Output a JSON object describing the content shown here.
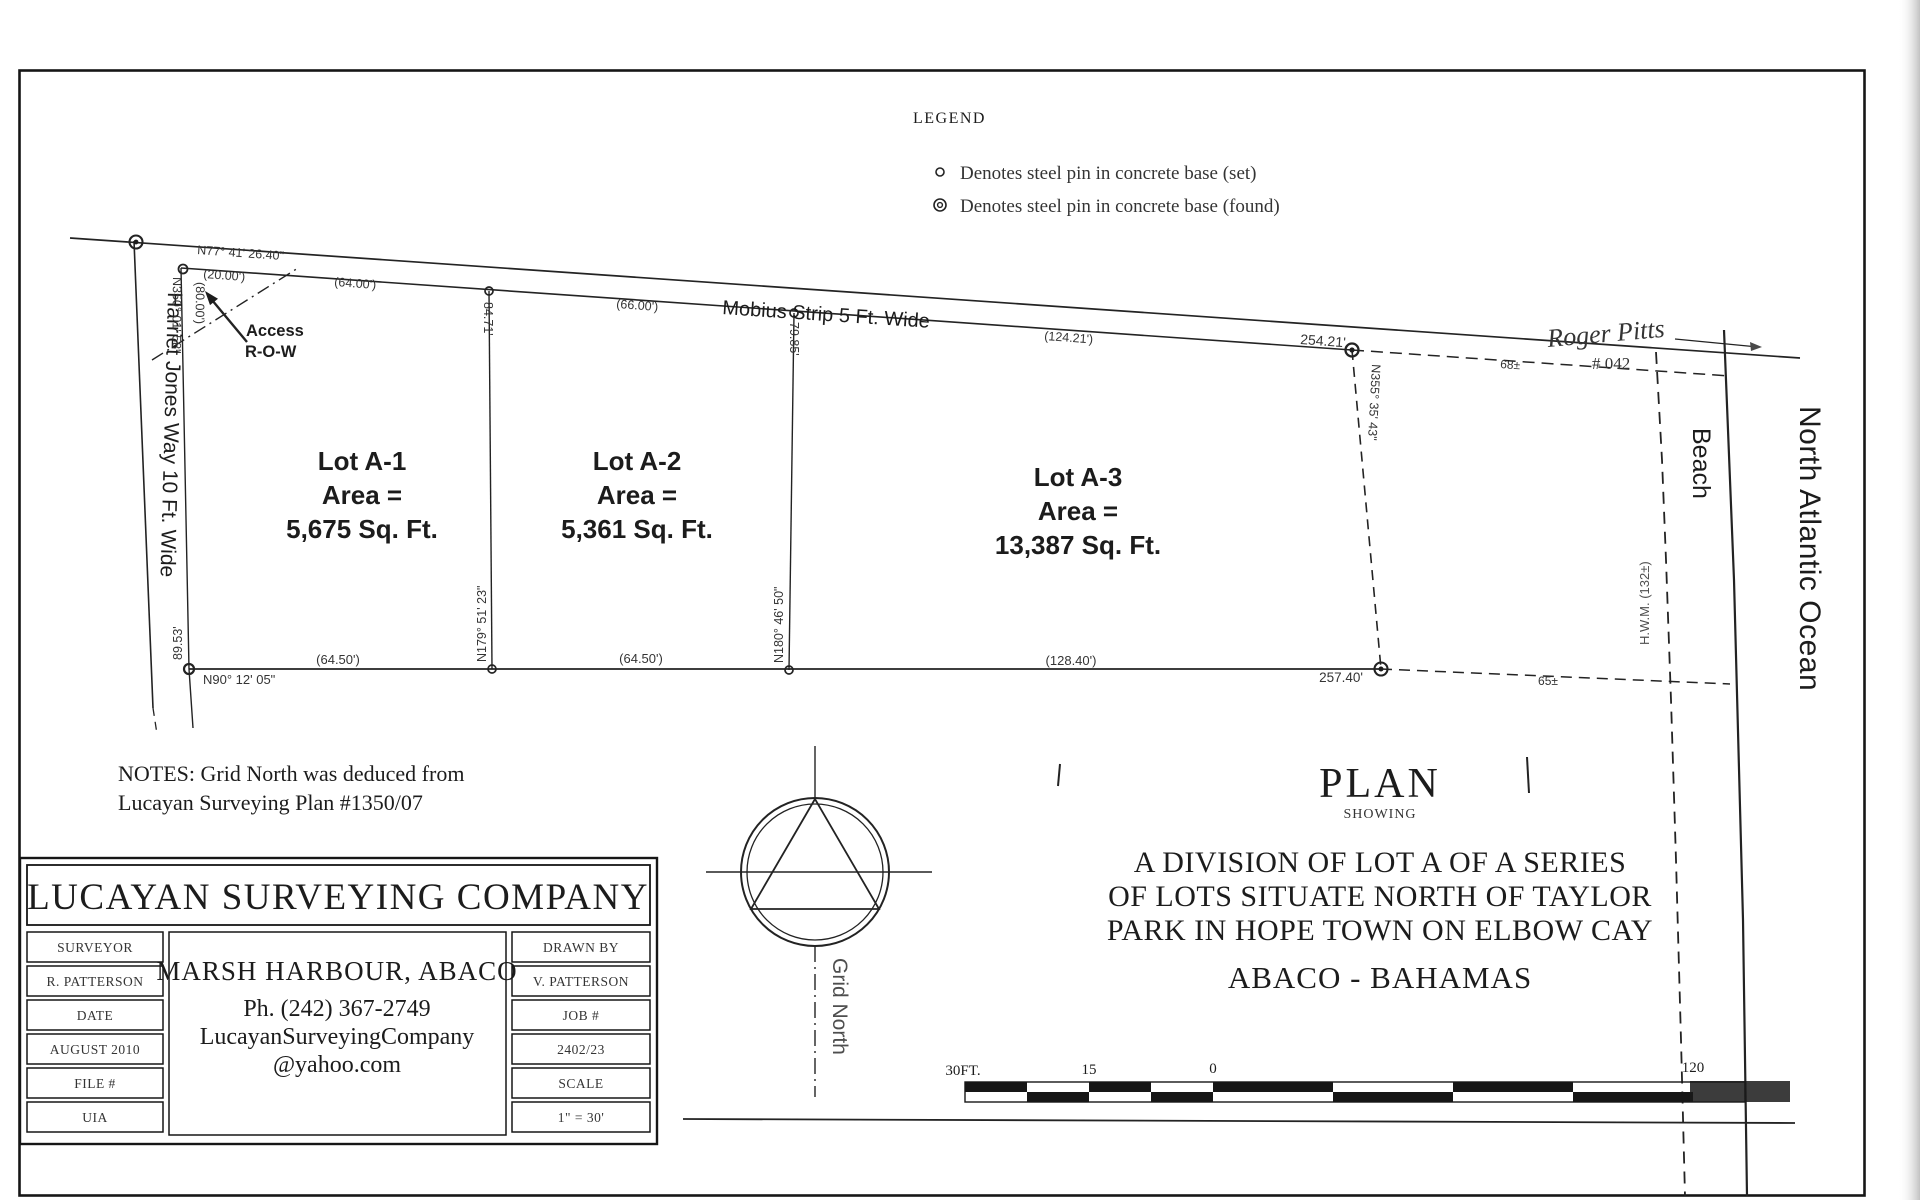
{
  "legend": {
    "title": "LEGEND",
    "items": [
      {
        "icon": "set-pin",
        "text": "Denotes steel pin in concrete base (set)"
      },
      {
        "icon": "found-pin",
        "text": "Denotes steel pin in concrete base (found)"
      }
    ]
  },
  "drawing": {
    "streets": {
      "harriet": "Harriet Jones Way  10 Ft. Wide",
      "mobius": "Mobius Strip  5 Ft. Wide"
    },
    "access": {
      "line1": "Access",
      "line2": "R-O-W"
    },
    "lots": [
      {
        "name": "Lot A-1",
        "area_eq": "Area =",
        "area": "5,675 Sq. Ft."
      },
      {
        "name": "Lot A-2",
        "area_eq": "Area =",
        "area": "5,361 Sq. Ft."
      },
      {
        "name": "Lot A-3",
        "area_eq": "Area =",
        "area": "13,387 Sq. Ft."
      }
    ],
    "dims": {
      "nw_bearing": "N77° 41' 26.40\"",
      "nw_dist": "(20.00')",
      "west_bearing": "N350° 01' 58\"",
      "west_dist": "(80.00')",
      "west_meas": "89.53'",
      "south_bearing": "N90° 12' 05\"",
      "a1_top": "(64.00')",
      "a1_bottom": "(64.50')",
      "a12_meas": "84.71'",
      "a12_bearing": "N179° 51' 23\"",
      "a2_top": "(66.00')",
      "a2_bottom": "(64.50')",
      "a23_meas": "79.85'",
      "a23_bearing": "N180° 46' 50\"",
      "a3_top": "(124.21')",
      "a3_bottom": "(128.40')",
      "east_top": "254.21'",
      "east_bottom": "257.40'",
      "east_bearing": "N355° 35' 43\"",
      "beach_top": "68±",
      "beach_bottom": "65±",
      "hwm_label": "H.W.M. (132±)"
    },
    "labels": {
      "beach": "Beach",
      "ocean": "North Atlantic Ocean",
      "grid_north": "Grid North"
    },
    "signature": {
      "name": "Roger Pitts",
      "number": "# 042"
    }
  },
  "notes": {
    "line1": "NOTES: Grid North was deduced from",
    "line2": "Lucayan Surveying Plan #1350/07"
  },
  "title_block": {
    "plan": "PLAN",
    "showing": "SHOWING",
    "line1": "A DIVISION OF LOT A OF A SERIES",
    "line2": "OF LOTS SITUATE NORTH OF TAYLOR",
    "line3": "PARK IN HOPE TOWN ON ELBOW CAY",
    "location": "ABACO - BAHAMAS"
  },
  "company": {
    "name": "LUCAYAN SURVEYING COMPANY",
    "left_rows": [
      "SURVEYOR",
      "R. PATTERSON",
      "DATE",
      "AUGUST 2010",
      "FILE #",
      "UIA"
    ],
    "center_rows": [
      "MARSH HARBOUR, ABACO",
      "Ph. (242) 367-2749",
      "LucayanSurveyingCompany",
      "@yahoo.com"
    ],
    "right_rows": [
      "DRAWN BY",
      "V. PATTERSON",
      "JOB #",
      "2402/23",
      "SCALE",
      "1\" = 30'"
    ]
  },
  "scale_bar": {
    "labels": [
      "30FT.",
      "15",
      "0",
      "120"
    ]
  }
}
